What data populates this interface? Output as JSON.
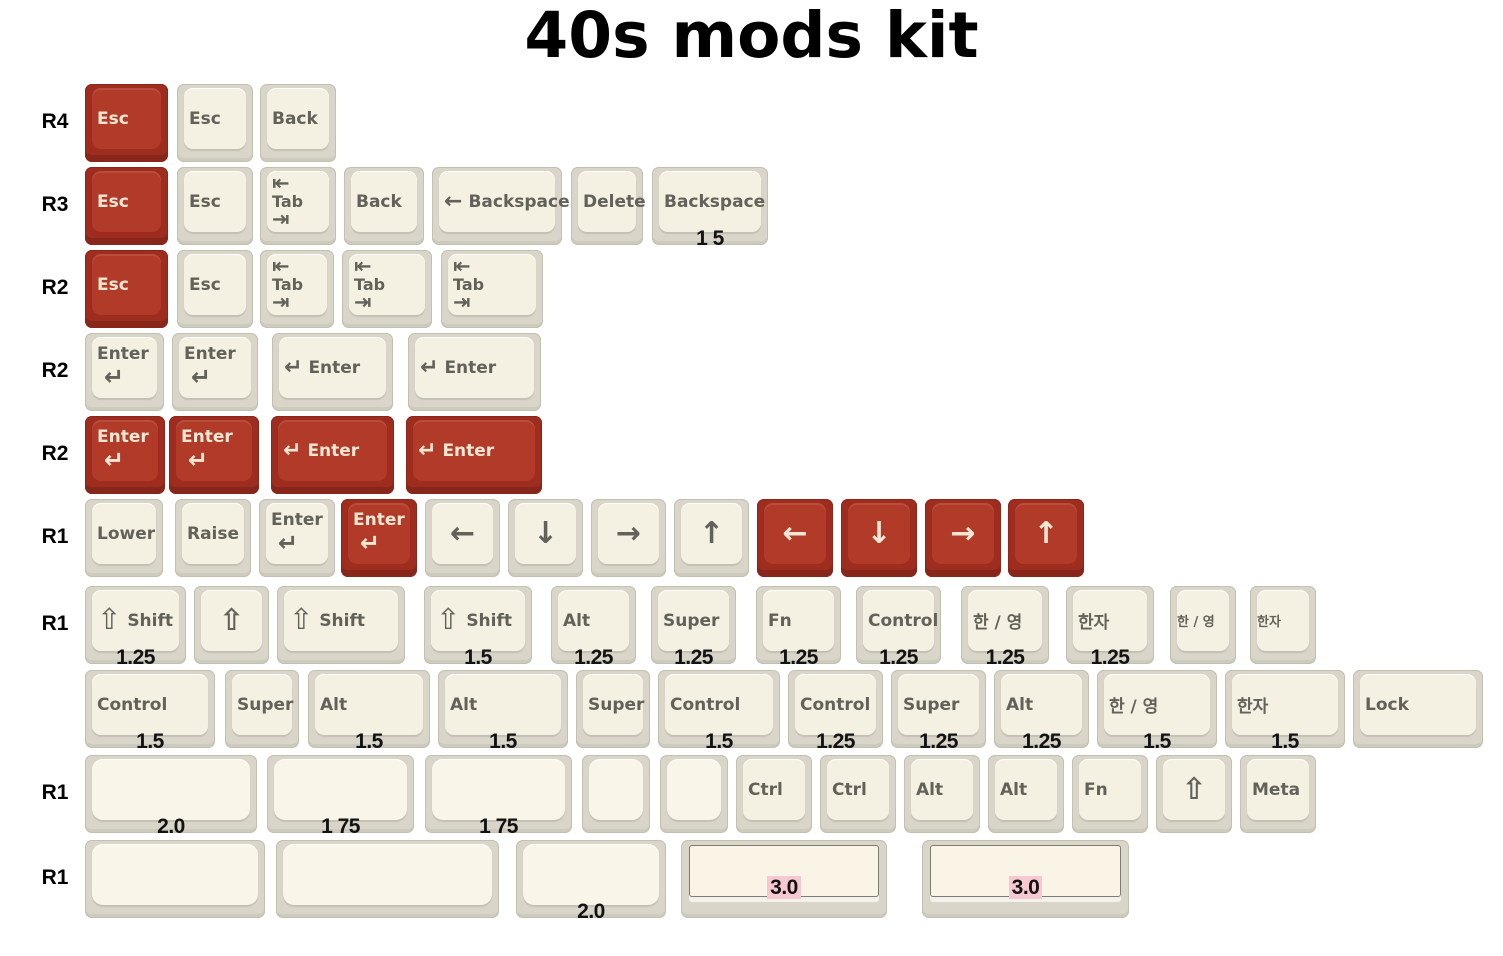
{
  "title": "40s mods kit",
  "colors": {
    "background": "#FFFFFF",
    "red_base": "#9E2D20",
    "red_top": "#B23A28",
    "red_legend": "#F1E7D4",
    "grey_base": "#D9D6C9",
    "grey_top": "#F5F1E2",
    "blank_top": "#F9F5E8",
    "grey_legend": "#62625B",
    "size_label": "#121212",
    "pink_highlight": "#F6C8D2",
    "title_color": "#000000"
  },
  "rows": [
    {
      "label": "R4",
      "y": 84,
      "keys": [
        {
          "name": "esc",
          "color": "red",
          "x": 85,
          "w": 83,
          "kind": "text",
          "text": "Esc"
        },
        {
          "name": "esc",
          "x": 177,
          "w": 76,
          "kind": "text",
          "text": "Esc"
        },
        {
          "name": "back",
          "x": 260,
          "w": 76,
          "kind": "text",
          "text": "Back"
        }
      ]
    },
    {
      "label": "R3",
      "y": 167,
      "keys": [
        {
          "name": "esc",
          "color": "red",
          "x": 85,
          "w": 83,
          "kind": "text",
          "text": "Esc"
        },
        {
          "name": "esc",
          "x": 177,
          "w": 76,
          "kind": "text",
          "text": "Esc"
        },
        {
          "name": "tab",
          "x": 260,
          "w": 76,
          "kind": "tab",
          "glyph_top": "⇤",
          "text": "Tab",
          "glyph_bottom": "⇥"
        },
        {
          "name": "back",
          "x": 344,
          "w": 80,
          "kind": "text",
          "text": "Back"
        },
        {
          "name": "backspace",
          "x": 432,
          "w": 130,
          "kind": "inline",
          "glyph": "←",
          "text": "Backspace"
        },
        {
          "name": "delete",
          "x": 571,
          "w": 72,
          "kind": "text",
          "text": "Delete"
        },
        {
          "name": "backspace",
          "x": 652,
          "w": 116,
          "kind": "text",
          "text": "Backspace",
          "size": "1 5"
        }
      ]
    },
    {
      "label": "R2",
      "y": 250,
      "keys": [
        {
          "name": "esc",
          "color": "red",
          "x": 85,
          "w": 83,
          "kind": "text",
          "text": "Esc"
        },
        {
          "name": "esc",
          "x": 177,
          "w": 76,
          "kind": "text",
          "text": "Esc"
        },
        {
          "name": "tab",
          "x": 260,
          "w": 74,
          "kind": "tab",
          "glyph_top": "⇤",
          "text": "Tab",
          "glyph_bottom": "⇥"
        },
        {
          "name": "tab",
          "x": 342,
          "w": 90,
          "kind": "tab",
          "glyph_top": "⇤",
          "text": "Tab",
          "glyph_bottom": "⇥"
        },
        {
          "name": "tab",
          "x": 441,
          "w": 102,
          "kind": "tab",
          "glyph_top": "⇤",
          "text": "Tab",
          "glyph_bottom": "⇥"
        }
      ]
    },
    {
      "label": "R2",
      "y": 333,
      "keys": [
        {
          "name": "enter",
          "x": 85,
          "w": 79,
          "kind": "stack",
          "text": "Enter",
          "glyph": "↵"
        },
        {
          "name": "enter",
          "x": 172,
          "w": 86,
          "kind": "stack",
          "text": "Enter",
          "glyph": "↵"
        },
        {
          "name": "enter",
          "x": 272,
          "w": 121,
          "kind": "inline",
          "glyph": "↵",
          "text": "Enter"
        },
        {
          "name": "enter",
          "x": 408,
          "w": 133,
          "kind": "inline",
          "glyph": "↵",
          "text": "Enter"
        }
      ]
    },
    {
      "label": "R2",
      "y": 416,
      "keys": [
        {
          "name": "enter",
          "color": "red",
          "x": 85,
          "w": 80,
          "kind": "stack",
          "text": "Enter",
          "glyph": "↵"
        },
        {
          "name": "enter",
          "color": "red",
          "x": 169,
          "w": 90,
          "kind": "stack",
          "text": "Enter",
          "glyph": "↵"
        },
        {
          "name": "enter",
          "color": "red",
          "x": 271,
          "w": 123,
          "kind": "inline",
          "glyph": "↵",
          "text": "Enter"
        },
        {
          "name": "enter",
          "color": "red",
          "x": 406,
          "w": 136,
          "kind": "inline",
          "glyph": "↵",
          "text": "Enter"
        }
      ]
    },
    {
      "label": "R1",
      "y": 499,
      "keys": [
        {
          "name": "lower",
          "x": 85,
          "w": 78,
          "kind": "text",
          "text": "Lower"
        },
        {
          "name": "raise",
          "x": 175,
          "w": 76,
          "kind": "text",
          "text": "Raise"
        },
        {
          "name": "enter",
          "x": 259,
          "w": 76,
          "kind": "stack",
          "text": "Enter",
          "glyph": "↵"
        },
        {
          "name": "enter",
          "color": "red",
          "x": 341,
          "w": 76,
          "kind": "stack",
          "text": "Enter",
          "glyph": "↵"
        },
        {
          "name": "arrow-left",
          "x": 425,
          "w": 75,
          "kind": "glyph",
          "glyph": "←"
        },
        {
          "name": "arrow-down",
          "x": 508,
          "w": 75,
          "kind": "glyph",
          "glyph": "↓"
        },
        {
          "name": "arrow-right",
          "x": 591,
          "w": 75,
          "kind": "glyph",
          "glyph": "→"
        },
        {
          "name": "arrow-up",
          "x": 674,
          "w": 75,
          "kind": "glyph",
          "glyph": "↑"
        },
        {
          "name": "arrow-left",
          "color": "red",
          "x": 757,
          "w": 76,
          "kind": "glyph",
          "glyph": "←"
        },
        {
          "name": "arrow-down",
          "color": "red",
          "x": 841,
          "w": 76,
          "kind": "glyph",
          "glyph": "↓"
        },
        {
          "name": "arrow-right",
          "color": "red",
          "x": 925,
          "w": 76,
          "kind": "glyph",
          "glyph": "→"
        },
        {
          "name": "arrow-up",
          "color": "red",
          "x": 1008,
          "w": 76,
          "kind": "glyph",
          "glyph": "↑"
        }
      ]
    },
    {
      "label": "R1",
      "y": 586,
      "keys": [
        {
          "name": "shift",
          "x": 85,
          "w": 101,
          "kind": "inline",
          "glyph": "⇧",
          "text": "Shift",
          "size": "1.25"
        },
        {
          "name": "shift",
          "x": 194,
          "w": 75,
          "kind": "glyph",
          "glyph": "⇧"
        },
        {
          "name": "shift",
          "x": 277,
          "w": 128,
          "kind": "inline",
          "glyph": "⇧",
          "text": "Shift"
        },
        {
          "name": "shift",
          "x": 424,
          "w": 108,
          "kind": "inline",
          "glyph": "⇧",
          "text": "Shift",
          "size": "1.5"
        },
        {
          "name": "alt",
          "x": 551,
          "w": 85,
          "kind": "text",
          "text": "Alt",
          "size": "1.25"
        },
        {
          "name": "super",
          "x": 651,
          "w": 85,
          "kind": "text",
          "text": "Super",
          "size": "1.25"
        },
        {
          "name": "fn",
          "x": 756,
          "w": 85,
          "kind": "text",
          "text": "Fn",
          "size": "1.25"
        },
        {
          "name": "control",
          "x": 856,
          "w": 85,
          "kind": "text",
          "text": "Control",
          "size": "1.25"
        },
        {
          "name": "han-yeong",
          "x": 961,
          "w": 88,
          "kind": "text",
          "text": "한 / 영",
          "size": "1.25"
        },
        {
          "name": "hanja",
          "x": 1066,
          "w": 88,
          "kind": "text",
          "text": "한자",
          "size": "1.25"
        },
        {
          "name": "han-yeong",
          "x": 1170,
          "w": 66,
          "kind": "text",
          "text": "한 / 영"
        },
        {
          "name": "hanja",
          "x": 1250,
          "w": 66,
          "kind": "text",
          "text": "한자"
        }
      ]
    },
    {
      "label": null,
      "y": 670,
      "keys": [
        {
          "name": "control",
          "x": 85,
          "w": 130,
          "kind": "text",
          "text": "Control",
          "size": "1.5"
        },
        {
          "name": "super",
          "x": 225,
          "w": 74,
          "kind": "text",
          "text": "Super"
        },
        {
          "name": "alt",
          "x": 308,
          "w": 122,
          "kind": "text",
          "text": "Alt",
          "size": "1.5"
        },
        {
          "name": "alt",
          "x": 438,
          "w": 130,
          "kind": "text",
          "text": "Alt",
          "size": "1.5"
        },
        {
          "name": "super",
          "x": 576,
          "w": 74,
          "kind": "text",
          "text": "Super"
        },
        {
          "name": "control",
          "x": 658,
          "w": 122,
          "kind": "text",
          "text": "Control",
          "size": "1.5"
        },
        {
          "name": "control",
          "x": 788,
          "w": 95,
          "kind": "text",
          "text": "Control",
          "size": "1.25"
        },
        {
          "name": "super",
          "x": 891,
          "w": 95,
          "kind": "text",
          "text": "Super",
          "size": "1.25"
        },
        {
          "name": "alt",
          "x": 994,
          "w": 95,
          "kind": "text",
          "text": "Alt",
          "size": "1.25"
        },
        {
          "name": "han-yeong",
          "x": 1097,
          "w": 120,
          "kind": "text",
          "text": "한 / 영",
          "size": "1.5"
        },
        {
          "name": "hanja",
          "x": 1225,
          "w": 120,
          "kind": "text",
          "text": "한자",
          "size": "1.5"
        },
        {
          "name": "lock",
          "x": 1353,
          "w": 130,
          "kind": "text",
          "text": "Lock"
        }
      ]
    },
    {
      "label": "R1",
      "y": 755,
      "keys": [
        {
          "name": "blank",
          "x": 85,
          "w": 172,
          "kind": "blank",
          "size": "2.0"
        },
        {
          "name": "blank",
          "x": 267,
          "w": 147,
          "kind": "blank",
          "size": "1 75"
        },
        {
          "name": "blank",
          "x": 425,
          "w": 147,
          "kind": "blank",
          "size": "1 75"
        },
        {
          "name": "blank",
          "x": 582,
          "w": 68,
          "kind": "blank"
        },
        {
          "name": "blank",
          "x": 660,
          "w": 68,
          "kind": "blank"
        },
        {
          "name": "ctrl",
          "x": 736,
          "w": 76,
          "kind": "text",
          "text": "Ctrl"
        },
        {
          "name": "ctrl",
          "x": 820,
          "w": 76,
          "kind": "text",
          "text": "Ctrl"
        },
        {
          "name": "alt",
          "x": 904,
          "w": 76,
          "kind": "text",
          "text": "Alt"
        },
        {
          "name": "alt",
          "x": 988,
          "w": 76,
          "kind": "text",
          "text": "Alt"
        },
        {
          "name": "fn",
          "x": 1072,
          "w": 76,
          "kind": "text",
          "text": "Fn"
        },
        {
          "name": "shift",
          "x": 1156,
          "w": 76,
          "kind": "glyph",
          "glyph": "⇧"
        },
        {
          "name": "meta",
          "x": 1240,
          "w": 76,
          "kind": "text",
          "text": "Meta"
        }
      ]
    },
    {
      "label": "R1",
      "y": 840,
      "keys": [
        {
          "name": "blank",
          "x": 85,
          "w": 180,
          "kind": "blank"
        },
        {
          "name": "blank",
          "x": 276,
          "w": 223,
          "kind": "blank"
        },
        {
          "name": "blank",
          "x": 516,
          "w": 150,
          "kind": "blank",
          "size": "2.0"
        },
        {
          "name": "spacebar",
          "x": 681,
          "w": 206,
          "kind": "space",
          "size": "3.0",
          "size_highlight": true
        },
        {
          "name": "spacebar",
          "x": 922,
          "w": 207,
          "kind": "space",
          "size": "3.0",
          "size_highlight": true
        }
      ]
    }
  ]
}
